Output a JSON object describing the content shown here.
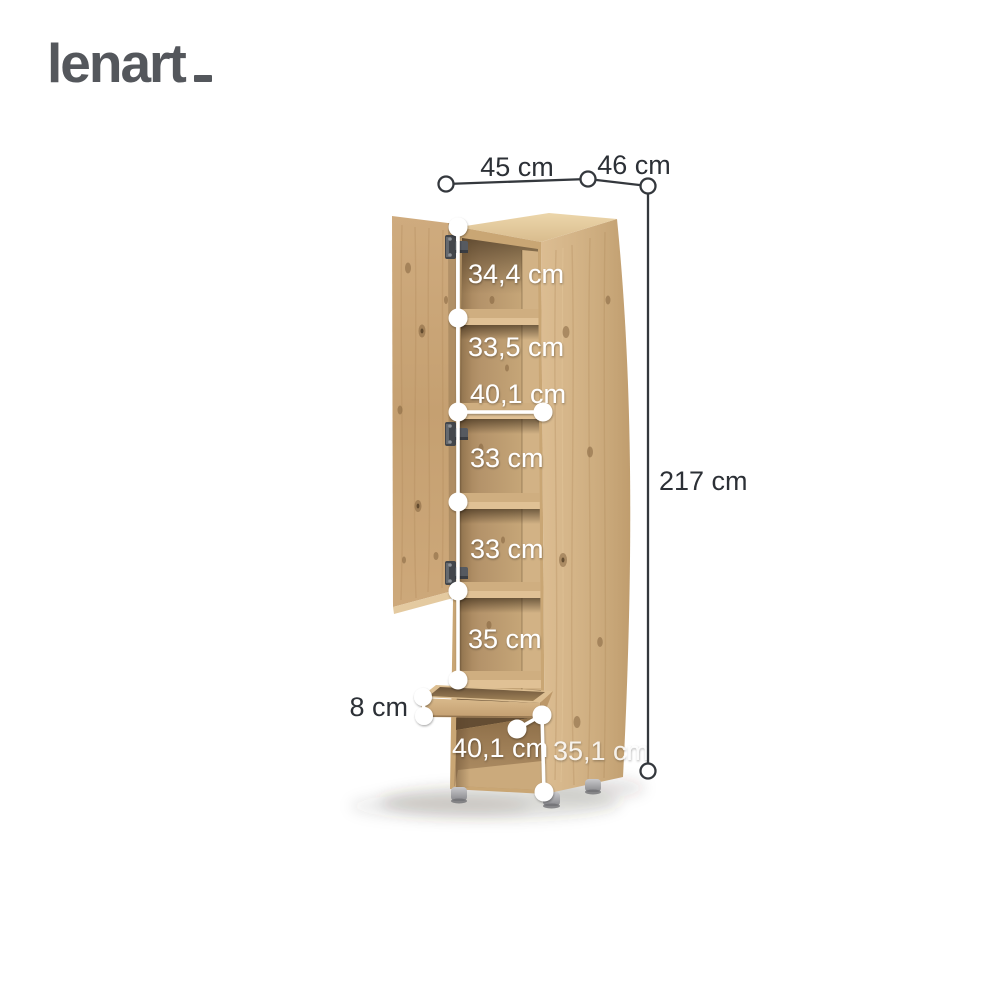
{
  "brand": {
    "logo": "lenart"
  },
  "product": {
    "description": "tall oak storage cabinet with open door, five shelf compartments and open drawer"
  },
  "colors": {
    "brand_text": "#54575c",
    "dimension_dark": "#2c3036",
    "dimension_white": "#ffffff",
    "wood_light": "#d3b386",
    "wood_medium": "#c9a674",
    "wood_dark": "#8a6a44",
    "interior_shadow": "#5e4830",
    "feet_gray": "#9b9b9f",
    "background": "#ffffff"
  },
  "dimensions": {
    "width": "45 cm",
    "depth": "46 cm",
    "height": "217 cm",
    "compartment_1": "34,4 cm",
    "compartment_2": "33,5 cm",
    "inner_width": "40,1 cm",
    "compartment_3": "33 cm",
    "compartment_4": "33 cm",
    "compartment_5": "35 cm",
    "drawer_height": "8 cm",
    "bottom_inner_width": "40,1 cm",
    "bottom_compartment_height": "35,1 cm"
  }
}
